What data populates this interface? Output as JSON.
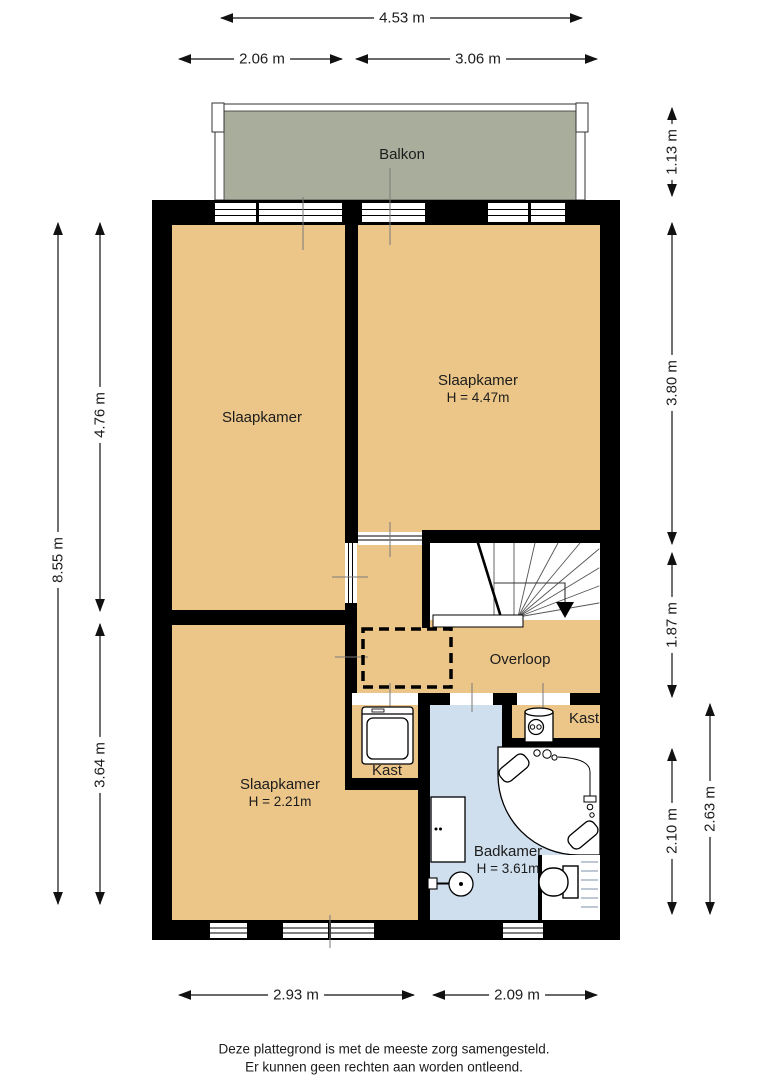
{
  "colors": {
    "wall": "#000000",
    "room": "#ecc689",
    "bath": "#cfdfee",
    "balcony": "#a9ad9c"
  },
  "rooms": {
    "balkon": {
      "label": "Balkon"
    },
    "slaapkamer_left": {
      "label": "Slaapkamer"
    },
    "slaapkamer_right": {
      "label": "Slaapkamer",
      "height": "H = 4.47m"
    },
    "slaapkamer_bottom": {
      "label": "Slaapkamer",
      "height": "H = 2.21m"
    },
    "overloop": {
      "label": "Overloop"
    },
    "badkamer": {
      "label": "Badkamer",
      "height": "H = 3.61m"
    },
    "kast_wasmachine": {
      "label": "Kast"
    },
    "kast_boiler": {
      "label": "Kast"
    }
  },
  "dimensions": {
    "top_total": "4.53 m",
    "top_left": "2.06 m",
    "top_right": "3.06 m",
    "left_total": "8.55 m",
    "left_upper": "4.76 m",
    "left_lower": "3.64 m",
    "right_balcony": "1.13 m",
    "right_upper": "3.80 m",
    "right_middle": "1.87 m",
    "right_lower_inner": "2.10 m",
    "right_lower_total": "2.63 m",
    "bottom_left": "2.93 m",
    "bottom_right": "2.09 m"
  },
  "footer": {
    "line1": "Deze plattegrond is met de meeste zorg samengesteld.",
    "line2": "Er kunnen geen rechten aan worden ontleend."
  }
}
